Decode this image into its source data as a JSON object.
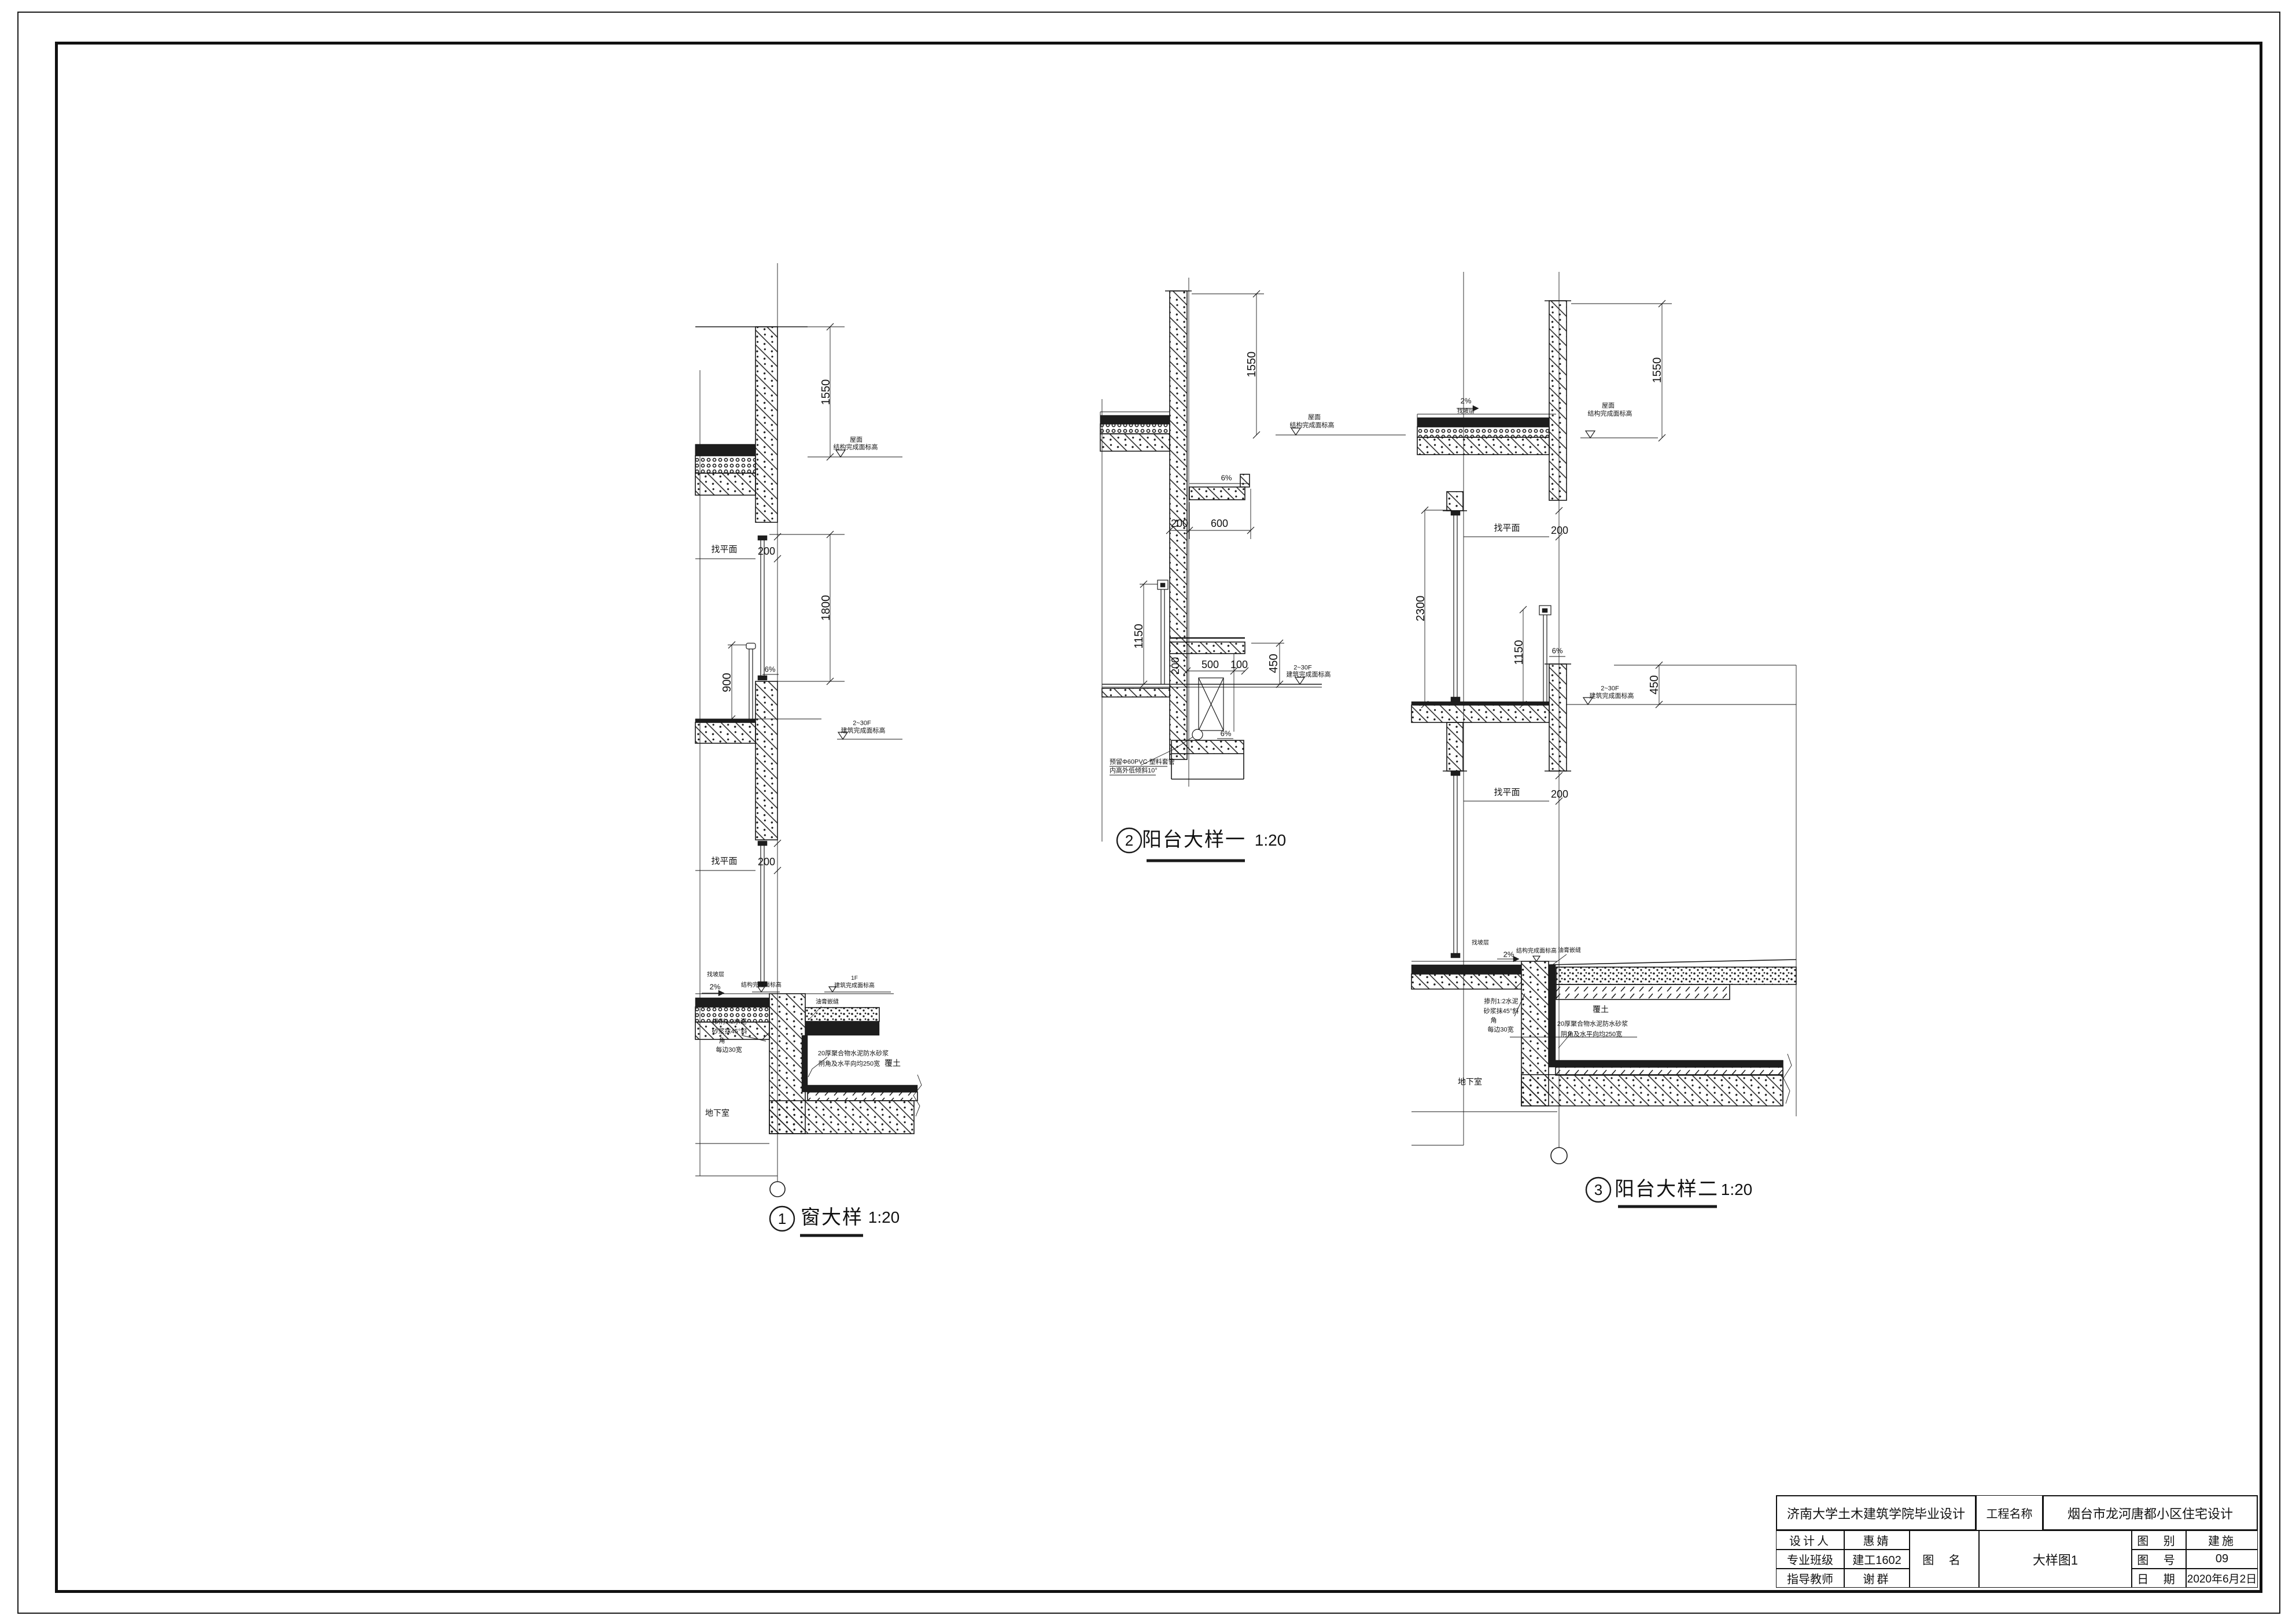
{
  "t": {
    "leveling": "找平面",
    "roof": "屋面",
    "struct_level": "结构完成面标高",
    "arch_level": "建筑完成面标高",
    "floors": "2~30F",
    "first_floor": "1F",
    "slope6": "6%",
    "slope2": "2%",
    "slope_layer": "找坡层",
    "sealant": "油膏嵌缝",
    "soil": "覆土",
    "basement": "地下室",
    "wp1": "20厚聚合物水泥防水砂浆",
    "wp2": "阴角及水平向均250宽",
    "m1": "掺剂1:2水泥",
    "m2": "砂浆抹45°斜",
    "m3": "角",
    "m4": "每边30宽",
    "pvc1": "预留Φ60PVC 塑料套管",
    "pvc2": "内高外低倾斜10°"
  },
  "d1": {
    "no": "1",
    "name": "窗大样",
    "scale": "1:20",
    "dim_parapet": "1550",
    "dim_head": "200",
    "dim_window": "1800",
    "dim_rail": "900",
    "dim_head2": "200"
  },
  "d2": {
    "no": "2",
    "name": "阳台大样一",
    "scale": "1:20",
    "dim_parapet": "1550",
    "dim_wall": "200",
    "dim_canopy": "600",
    "dim_rail": "1150",
    "dim_wall2": "200",
    "dim_clear": "500",
    "dim_upstand": "100",
    "dim_upturn": "450"
  },
  "d3": {
    "no": "3",
    "name": "阳台大样二",
    "scale": "1:20",
    "dim_parapet": "1550",
    "dim_head": "200",
    "dim_door": "2300",
    "dim_rail": "1150",
    "dim_upturn": "450",
    "dim_head2": "200"
  },
  "tb": {
    "school": "济南大学土木建筑学院毕业设计",
    "project_label": "工程名称",
    "project": "烟台市龙河唐都小区住宅设计",
    "designer_label": "设计人",
    "designer": "惠婧",
    "class_label": "专业班级",
    "class_value": "建工1602",
    "teacher_label": "指导教师",
    "teacher": "谢群",
    "name_label": "图 名",
    "drawing_name": "大样图1",
    "type_label": "图 别",
    "type_value": "建施",
    "no_label": "图 号",
    "no_value": "09",
    "date_label": "日 期",
    "date_value": "2020年6月2日"
  }
}
